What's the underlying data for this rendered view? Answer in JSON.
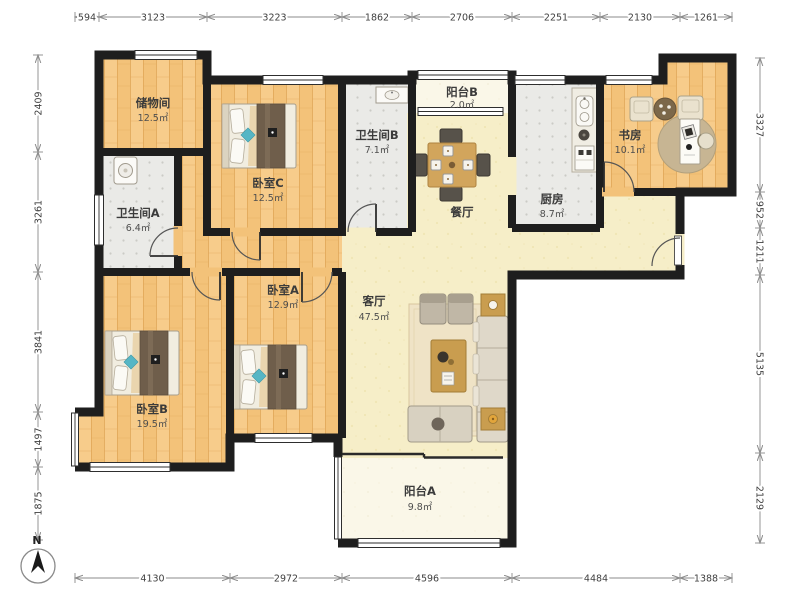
{
  "compass": {
    "label": "N"
  },
  "dimensions": {
    "top": [
      "594",
      "3123",
      "3223",
      "1862",
      "2706",
      "2251",
      "2130",
      "1261"
    ],
    "bottom": [
      "4130",
      "2972",
      "4596",
      "4484",
      "1388"
    ],
    "left": [
      "2409",
      "3261",
      "3841",
      "1497",
      "1875"
    ],
    "right": [
      "3327",
      "952",
      "1211",
      "5135",
      "2129"
    ]
  },
  "rooms": {
    "storage": {
      "name": "储物间",
      "area": "12.5㎡"
    },
    "bedroom_c": {
      "name": "卧室C",
      "area": "12.5㎡"
    },
    "bathroom_a": {
      "name": "卫生间A",
      "area": "6.4㎡"
    },
    "bathroom_b": {
      "name": "卫生间B",
      "area": "7.1㎡"
    },
    "balcony_b": {
      "name": "阳台B",
      "area": "2.0㎡"
    },
    "dining": {
      "name": "餐厅",
      "area": ""
    },
    "kitchen": {
      "name": "厨房",
      "area": "8.7㎡"
    },
    "study": {
      "name": "书房",
      "area": "10.1㎡"
    },
    "living": {
      "name": "客厅",
      "area": "47.5㎡"
    },
    "bedroom_a": {
      "name": "卧室A",
      "area": "12.9㎡"
    },
    "bedroom_b": {
      "name": "卧室B",
      "area": "19.5㎡"
    },
    "balcony_a": {
      "name": "阳台A",
      "area": "9.8㎡"
    }
  },
  "colors": {
    "wall": "#1e1e1e",
    "wood_floor": "#F3C279",
    "cream_floor": "#F6EEC8",
    "tile_floor": "#EAEAE7",
    "balcony_floor": "#FAF7E8",
    "accent_teal": "#56B6C5",
    "table_wood": "#C99D4F"
  }
}
